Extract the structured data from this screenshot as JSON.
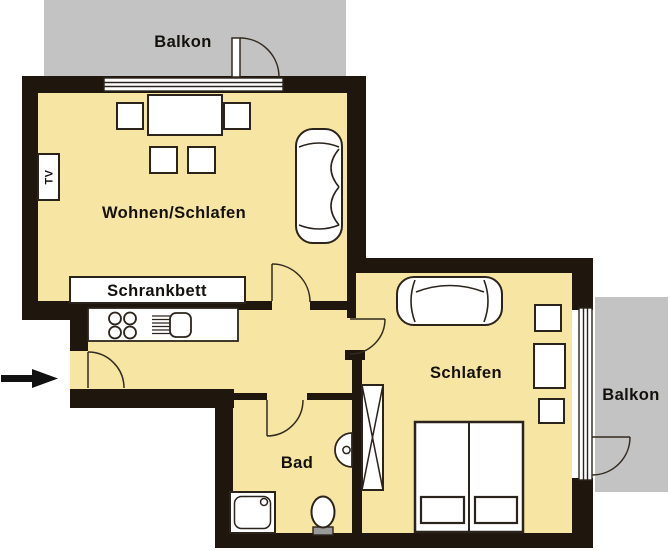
{
  "rooms": {
    "living": {
      "label": "Wohnen/Schlafen"
    },
    "sleeping": {
      "label": "Schlafen"
    },
    "bath": {
      "label": "Bad"
    },
    "balcony_top": {
      "label": "Balkon"
    },
    "balcony_right": {
      "label": "Balkon"
    }
  },
  "fixtures": {
    "wall_bed": {
      "label": "Schrankbett"
    },
    "tv": {
      "label": "TV"
    }
  },
  "colors": {
    "floor": "#F7E6A3",
    "wall": "#1F170D",
    "balcony": "#C3C3C3",
    "line": "#332B20",
    "tank": "#9A9A9A",
    "arrow": "#111111"
  }
}
